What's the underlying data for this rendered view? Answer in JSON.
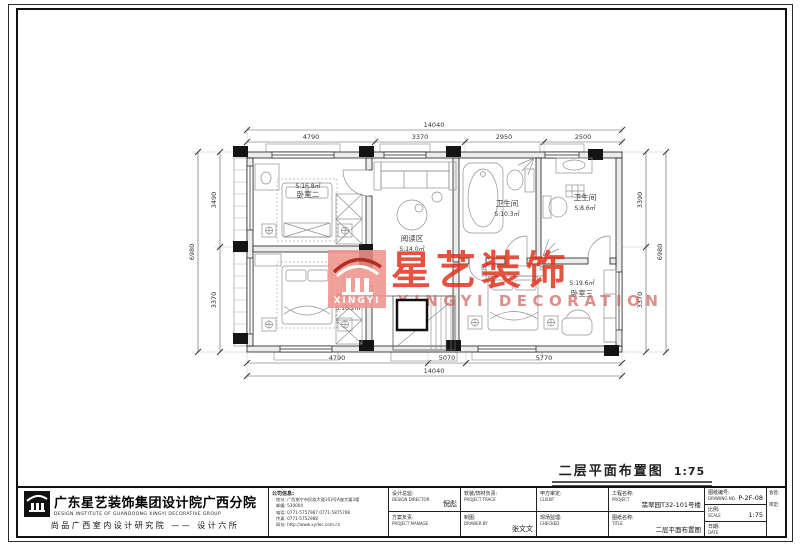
{
  "plan": {
    "title": "二层平面布置图",
    "scale": "1:75",
    "rooms": [
      {
        "name": "卧室二",
        "area": "S:16.8㎡"
      },
      {
        "name": "卧室一",
        "area": "S:16.2㎡"
      },
      {
        "name": "阅读区",
        "area": "S:14.0㎡"
      },
      {
        "name": "卫生间",
        "area": "S:10.3㎡"
      },
      {
        "name": "卫生间",
        "area": "S:8.6㎡"
      },
      {
        "name": "卧室三",
        "area": "S:19.6㎡"
      }
    ],
    "dims": {
      "top_total": "14040",
      "top": [
        "4790",
        "3370",
        "2950",
        "2500"
      ],
      "bottom": [
        "4790",
        "5070",
        "5770"
      ],
      "bottom_total": "14040",
      "left": [
        "3490",
        "3370"
      ],
      "left_total": "6980",
      "right": [
        "3390",
        "3370"
      ],
      "right_total": "6980"
    }
  },
  "watermark": {
    "logo": "XINGYI",
    "cn": "星艺装饰",
    "en": "XINGYI DECORATION",
    "red": "#e02c12",
    "pink": "#f2948c"
  },
  "titleblock": {
    "company_cn": "广东星艺装饰集团设计院广西分院",
    "company_en": "DESIGN INSTITUTE OF GUANDOONG XINGYI DECORATIVE GROUP",
    "company_sub": "尚品广西室内设计研究院 —— 设计六所",
    "info": {
      "label": "公司信息:",
      "lines": [
        "地址: 广西南宁市民族大道103号A座大厦3楼",
        "邮编: 530000",
        "电话: 0771-5757987  0771-5875708",
        "传真: 0771-5752988",
        "网址: http://www.xydec.com.cn"
      ]
    },
    "director": {
      "label": "设计总监:",
      "en": "DESIGN DIRECTOR",
      "value": "倪彪"
    },
    "manager": {
      "label": "方案负责:",
      "en": "PROJECT MANAGE",
      "value": ""
    },
    "material": {
      "label": "软装/饰材负责:",
      "en": "PROJECT TRACE",
      "value": ""
    },
    "drawer": {
      "label": "制图:",
      "en": "DRAWER BY",
      "value": "张文文"
    },
    "client": {
      "label": "甲方审定:",
      "en": "CLIENT",
      "value": ""
    },
    "checked": {
      "label": "现场监理:",
      "en": "CHECKED",
      "value": ""
    },
    "project": {
      "label": "工程名称:",
      "en": "PROJECT",
      "value": "翡翠园T32-101号楼"
    },
    "sheet": {
      "label": "图纸名称:",
      "en": "TITLE",
      "value": "二层平面布置图"
    },
    "number": {
      "label": "图纸编号:",
      "en": "DRAWING NO.",
      "value": "P-2F-08"
    },
    "scale": {
      "label": "比例:",
      "en": "SCALE",
      "value": "1:75"
    },
    "date": {
      "label": "日期:",
      "en": "DATE",
      "value": ""
    },
    "sign": {
      "line1": "会签:",
      "line2": "审定:"
    }
  }
}
